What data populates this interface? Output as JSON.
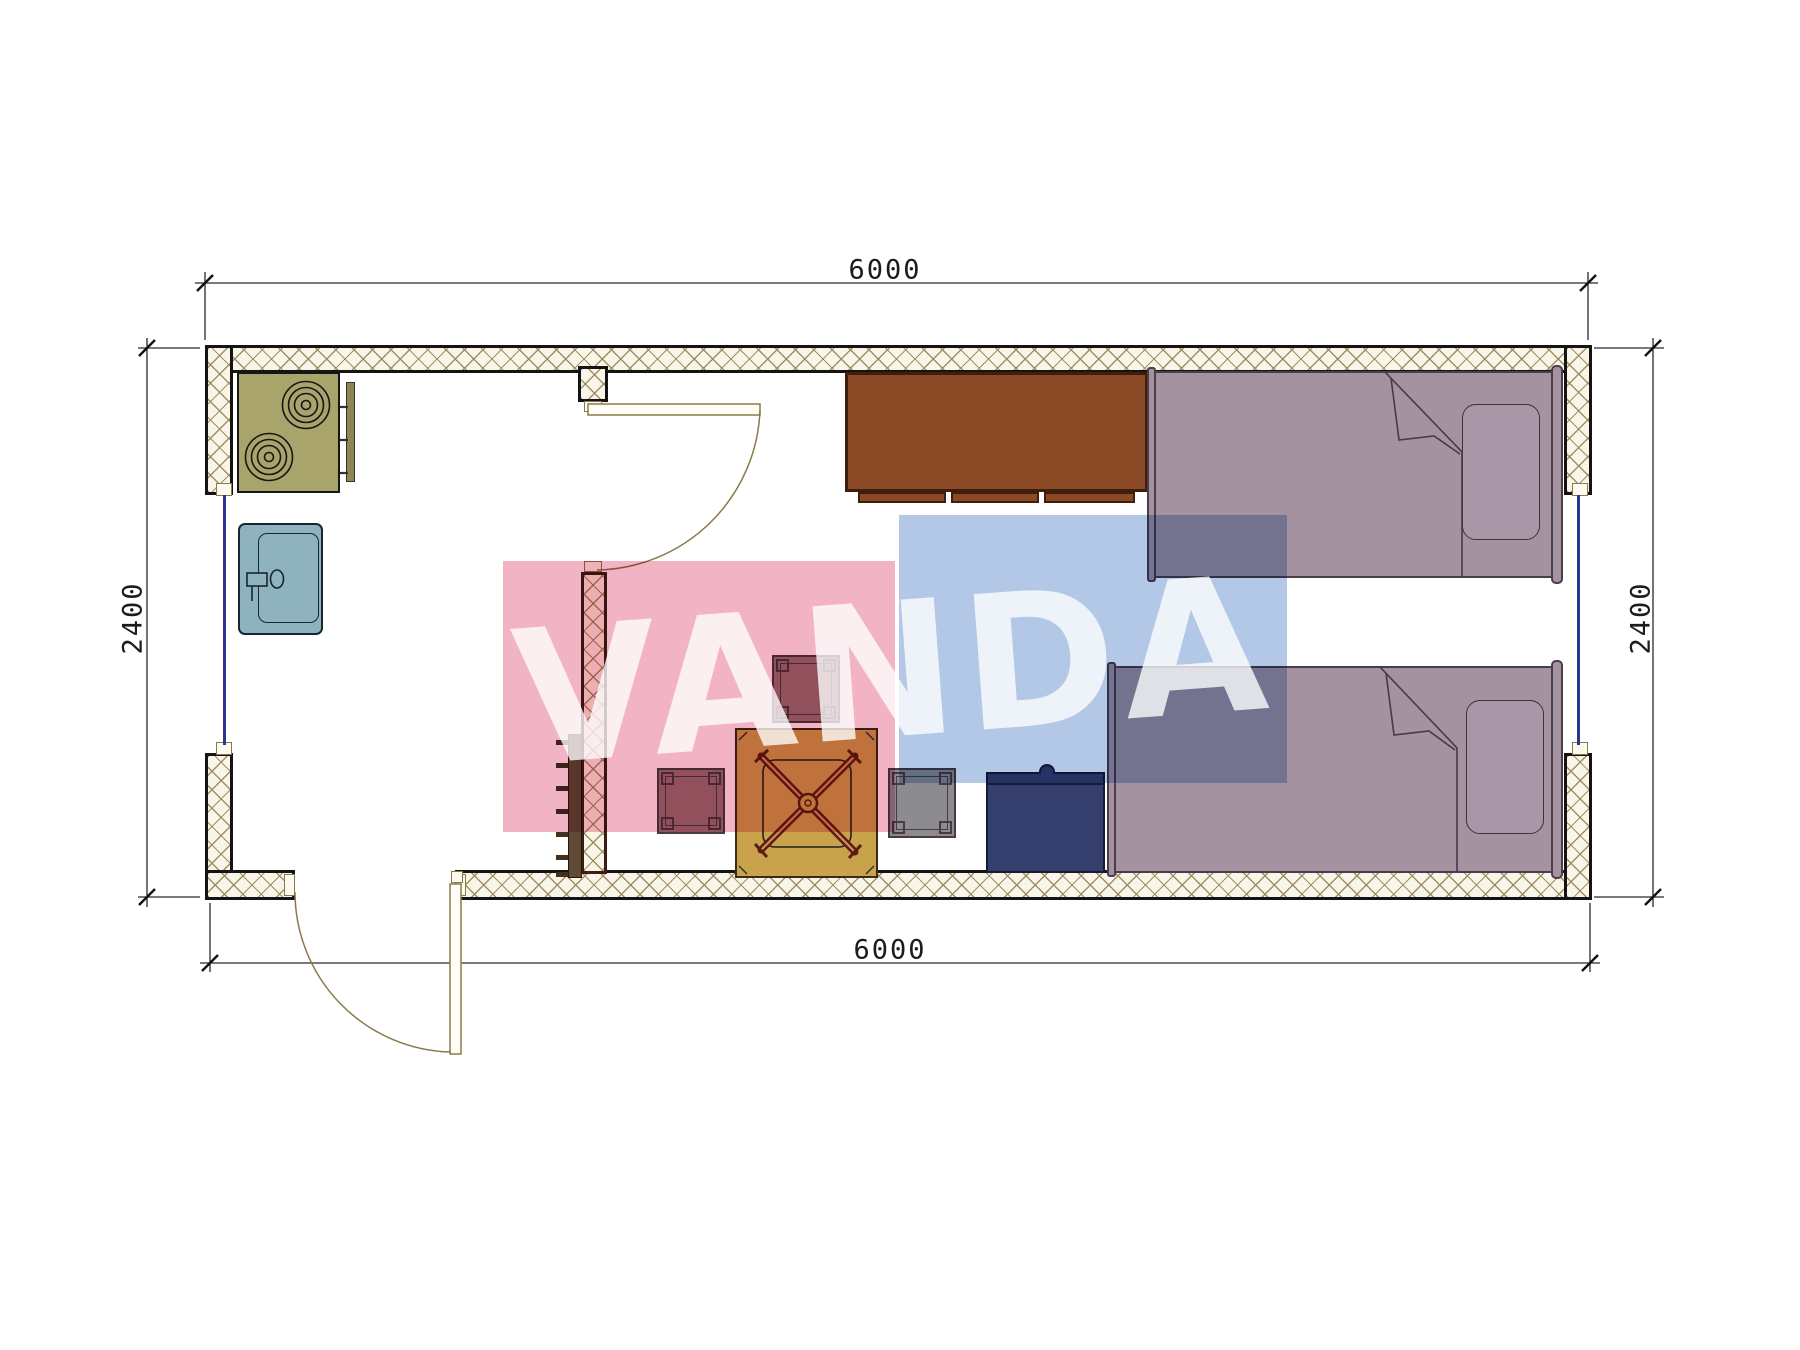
{
  "watermark": {
    "text": "VANDA",
    "pink_color": "#f2b4c4",
    "blue_color": "#b2c8e6",
    "text_color": "#ffffff"
  },
  "dimensions": {
    "width_top": "6000",
    "width_bottom": "6000",
    "height_left": "2400",
    "height_right": "2400"
  },
  "plan": {
    "wall_hatch_color": "#9a8a5c",
    "wall_line_color": "#141414",
    "door_line_color": "#8a7a4a",
    "window_line_color": "#2a3590",
    "furniture": [
      {
        "name": "stove-cooktop",
        "color": "#a9a46b"
      },
      {
        "name": "kitchen-counter-strip",
        "color": "#8c8752"
      },
      {
        "name": "sink",
        "color": "#8fb2bf"
      },
      {
        "name": "wardrobe-cabinet",
        "color": "#8b4a26"
      },
      {
        "name": "bed-1",
        "color": "#a492a0"
      },
      {
        "name": "bed-2",
        "color": "#a492a0"
      },
      {
        "name": "nightstand",
        "color": "#35406e"
      },
      {
        "name": "table",
        "color": "#c9a24c"
      },
      {
        "name": "stool",
        "color": "#8c8c90"
      },
      {
        "name": "radiator-rack",
        "color": "#5f4a35"
      }
    ]
  }
}
